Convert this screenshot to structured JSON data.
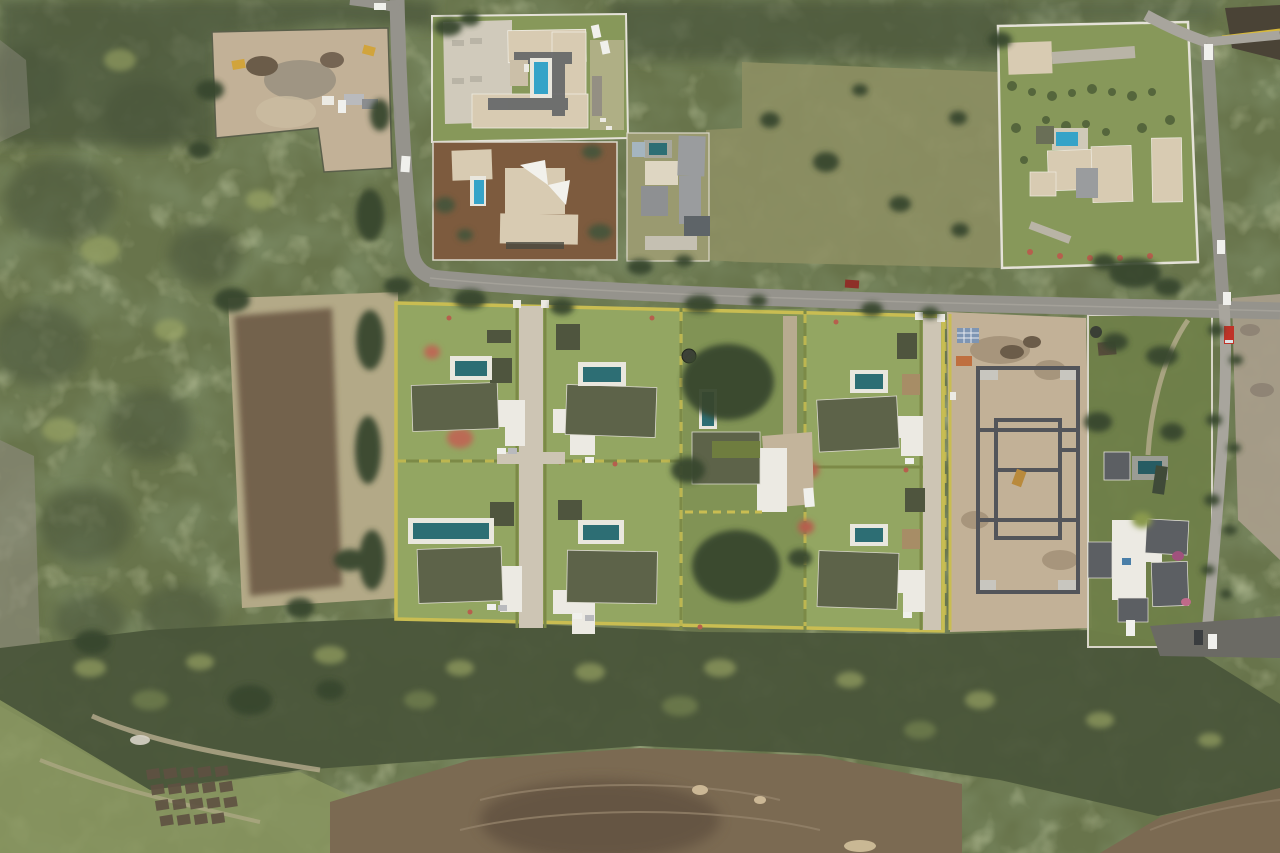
{
  "image": {
    "kind": "aerial-drone-photograph",
    "description": "Top-down aerial view of a tropical residential villa development: six rendered villas with private pools arranged around a central paver lane, an existing house on a large treed middle lot, a construction site with grey concrete foundations, established walled estates with pools along a grey asphalt road, cleared earth plots, dense woodland bands and small garden beds at lower left.",
    "width_px": 1280,
    "height_px": 853
  },
  "counts": {
    "rendered_villas": 6,
    "villa_pools": 6,
    "total_pools_visible": 13,
    "construction_sites": 2,
    "vehicles_visible": 16
  },
  "areas": {
    "top_left": "cleared construction plot with excavators and containers in woodland",
    "top_center": "walled estate with U-shaped beige roof house, blue pool and concrete parking",
    "top_right": "large walled lawn estate with beige roofed house, pool and young trees",
    "center": "villa development render: six olive-roofed villas with pools and white garages",
    "center_middle_lot": "existing home on large lot with mature trees and lap pool",
    "center_right": "construction site with concrete foundation walls on bare earth",
    "right": "lush walled estate with dark roofed house, pool and tree-lined driveway",
    "left": "dry pale field with dark tilled swath surrounded by scrub forest",
    "bottom": "dense tree band, cleared brown earth and small garden plots"
  },
  "colors": {
    "vegBase": "#68744b",
    "vegDark": "#49553a",
    "vegDarker": "#38462e",
    "vegLight": "#8a9660",
    "canopyYellow": "#a9b46c",
    "lawnEstate": "#87985a",
    "lawnVilla": "#93a662",
    "lawnMiddle": "#7f9154",
    "fieldPale": "#b3a987",
    "fieldBrown": "#6e5c46",
    "dirtTan": "#c2b197",
    "dirtBrown": "#7b6a52",
    "dirtDark": "#5d4e3c",
    "dirtGray": "#a89d8a",
    "road": "#95938c",
    "roadLight": "#a8a59d",
    "asphaltDark": "#6b6a64",
    "paver": "#cdc5b4",
    "concrete": "#d0cabb",
    "pathPale": "#b7ad8e",
    "dirtDrive": "#b8ab90",
    "roofBeige": "#d8cbb2",
    "roofGray": "#9a9c9e",
    "roofDark": "#5c5f63",
    "roofOlive": "#5d6349",
    "roofGreen": "#6f7d3f",
    "roofCream": "#ded6c2",
    "pavilion": "#4f553e",
    "pavilionTan": "#a78d66",
    "white": "#eceae3",
    "poolBright": "#35a3c8",
    "poolTeal": "#2d6e74",
    "poolDark": "#275c63",
    "poolDeck": "#e9e7de",
    "hedgeYellow": "#c9bd52",
    "hedgeGreen": "#7c8a47",
    "flowerRed": "#b65f4d",
    "wallWhite": "#e5e2d8",
    "foundation": "#53555a",
    "rock": "#8f8c7f",
    "gravel": "#99917f",
    "spoil": "#6b5c49",
    "excavator": "#d1a43c",
    "truckRed": "#c03328",
    "carWhite": "#f0f0ec",
    "carGray": "#b9babd",
    "shedBlue": "#7e95b3",
    "scrubDry": "#8d8f63",
    "greenhouse": "#3f4a38",
    "solarBlue": "#4a7fa8",
    "track": "#93826a",
    "dirtRed": "#7d5b3e",
    "lawnDry": "#9a9a70"
  }
}
